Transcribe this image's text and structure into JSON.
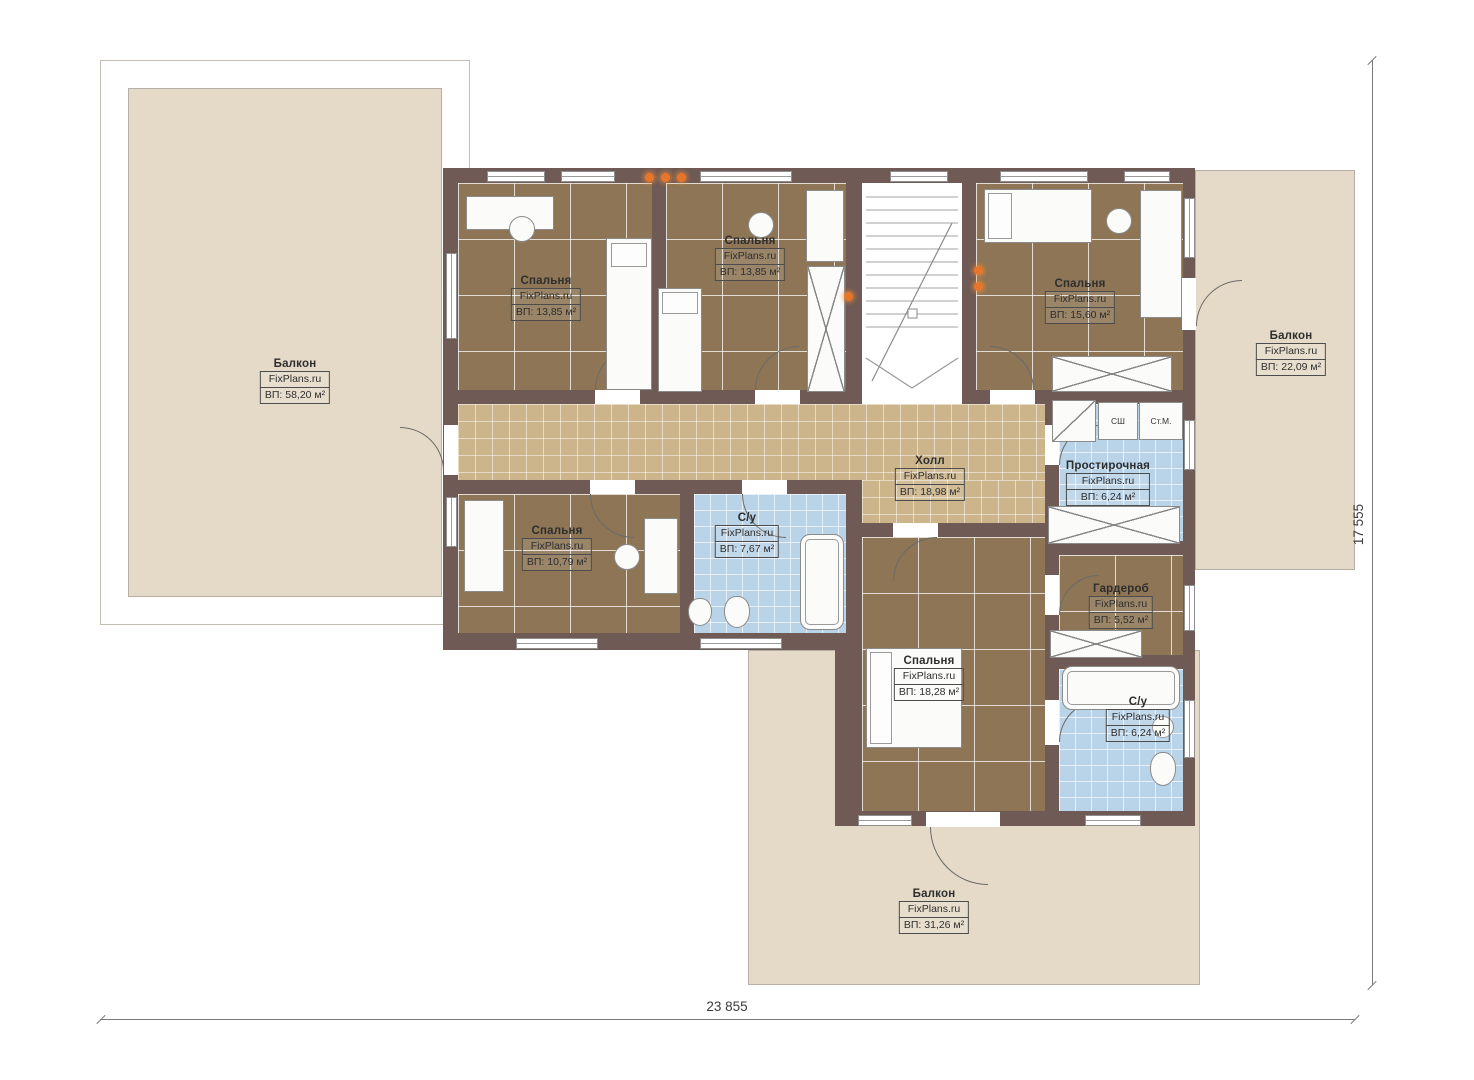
{
  "plan": {
    "brand": "FixPlans.ru",
    "rooms": [
      {
        "id": "balcony-left",
        "name": "Балкон",
        "brand": "FixPlans.ru",
        "area": "ВП: 58,20 м²"
      },
      {
        "id": "bedroom-tl",
        "name": "Спальня",
        "brand": "FixPlans.ru",
        "area": "ВП: 13,85 м²"
      },
      {
        "id": "bedroom-tm",
        "name": "Спальня",
        "brand": "FixPlans.ru",
        "area": "ВП: 13,85 м²"
      },
      {
        "id": "bedroom-tr",
        "name": "Спальня",
        "brand": "FixPlans.ru",
        "area": "ВП: 15,60 м²"
      },
      {
        "id": "balcony-right",
        "name": "Балкон",
        "brand": "FixPlans.ru",
        "area": "ВП: 22,09 м²"
      },
      {
        "id": "hall",
        "name": "Холл",
        "brand": "FixPlans.ru",
        "area": "ВП: 18,98 м²"
      },
      {
        "id": "laundry",
        "name": "Простирочная",
        "brand": "FixPlans.ru",
        "area": "ВП: 6,24 м²"
      },
      {
        "id": "bedroom-bl",
        "name": "Спальня",
        "brand": "FixPlans.ru",
        "area": "ВП: 10,79 м²"
      },
      {
        "id": "bathroom-1",
        "name": "С/у",
        "brand": "FixPlans.ru",
        "area": "ВП: 7,67 м²"
      },
      {
        "id": "wardrobe",
        "name": "Гардероб",
        "brand": "FixPlans.ru",
        "area": "ВП: 5,52 м²"
      },
      {
        "id": "bedroom-bottom",
        "name": "Спальня",
        "brand": "FixPlans.ru",
        "area": "ВП: 18,28 м²"
      },
      {
        "id": "bathroom-2",
        "name": "С/у",
        "brand": "FixPlans.ru",
        "area": "ВП: 6,24 м²"
      },
      {
        "id": "balcony-bottom",
        "name": "Балкон",
        "brand": "FixPlans.ru",
        "area": "ВП: 31,26 м²"
      }
    ],
    "appliances": {
      "dryer": "СШ",
      "washer": "Ст.М."
    },
    "dimensions": {
      "width": "23 855",
      "height": "17 555"
    },
    "colors": {
      "wall": "#6f5a56",
      "bedroom_floor": "#8d7555",
      "hall_floor": "#ccb48b",
      "bath_floor": "#b9d3e9",
      "balcony": "#e5dac7",
      "accent_light": "#e8762a"
    }
  }
}
